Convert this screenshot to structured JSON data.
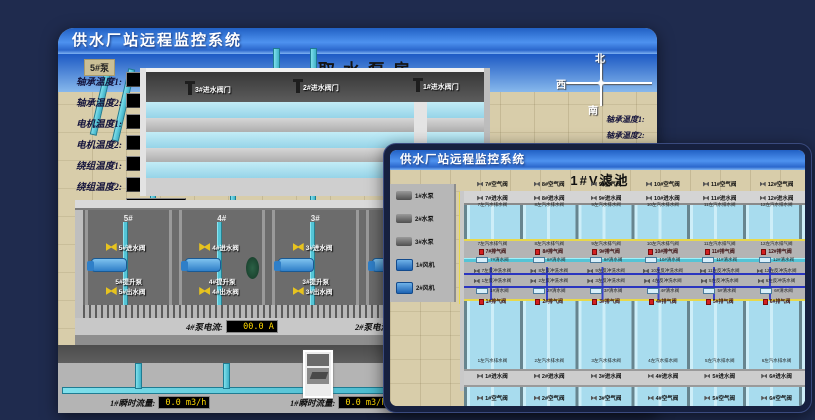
{
  "back_window": {
    "title": "供水厂站远程监控系统",
    "scene_title": "取水泵房",
    "pump_panel": {
      "tab": "5#泵",
      "rows": [
        {
          "label": "轴承温度1:",
          "value": "100.0℃"
        },
        {
          "label": "轴承温度2:",
          "value": "100.0℃"
        },
        {
          "label": "电机温度1:",
          "value": "18.1℃"
        },
        {
          "label": "电机温度2:",
          "value": "17.9℃"
        },
        {
          "label": "绕组温度1:",
          "value": "18.0℃"
        },
        {
          "label": "绕组温度2:",
          "value": "18.1℃"
        },
        {
          "label": "绕组温度3:",
          "value": "18.1℃"
        },
        {
          "label": "管道压力:",
          "value": "0.000MPa"
        },
        {
          "label": "多功能阀:",
          "value": "0%"
        }
      ]
    },
    "compass": {
      "north": "北",
      "west": "西",
      "south": "南"
    },
    "right_panel_labels": [
      {
        "label": "轴承温度1:"
      },
      {
        "label": "轴承温度2:"
      }
    ],
    "inlet_valves": [
      {
        "label": "3#进水阀门"
      },
      {
        "label": "2#进水阀门"
      },
      {
        "label": "1#进水阀门"
      }
    ],
    "pump_bays": [
      {
        "id": "5#",
        "inlet": "5#进水阀",
        "pump": "5#提升泵",
        "outlet": "5#出水阀"
      },
      {
        "id": "4#",
        "inlet": "4#进水阀",
        "pump": "4#提升泵",
        "outlet": "4#出水阀"
      },
      {
        "id": "3#",
        "inlet": "3#进水阀",
        "pump": "3#提升泵",
        "outlet": "3#出水阀"
      },
      {
        "id": "2#",
        "inlet": "2#进水阀",
        "pump": "2#提升泵",
        "outlet": "2#出水阀"
      }
    ],
    "current_displays": [
      {
        "label": "4#泵电流:",
        "value": "00.0 A"
      },
      {
        "label": "2#泵电流:",
        "value": ""
      }
    ],
    "flow_displays": [
      {
        "label": "1#瞬时流量:",
        "value": "0.0 m3/h"
      },
      {
        "label": "1#瞬时流量:",
        "value": "0.0 m3/h"
      }
    ]
  },
  "front_window": {
    "title": "供水厂站远程监控系统",
    "scene_title": "1#V滤池",
    "equipment": [
      {
        "label": "1#水泵"
      },
      {
        "label": "2#水泵"
      },
      {
        "label": "3#水泵"
      },
      {
        "label": "1#风机"
      },
      {
        "label": "2#风机"
      }
    ],
    "top_cells": [
      {
        "air": "7#空气阀",
        "inlet": "7#进水阀",
        "drain": "7左汽水排水阀",
        "vent": "7左汽水排气阀",
        "exhaust": "7#排气阀",
        "clean": "7#清水阀",
        "backwash": "7左反冲洗水阀"
      },
      {
        "air": "8#空气阀",
        "inlet": "8#进水阀",
        "drain": "8左汽水排水阀",
        "vent": "8左汽水排气阀",
        "exhaust": "8#排气阀",
        "clean": "8#清水阀",
        "backwash": "8左反冲洗水阀"
      },
      {
        "air": "9#空气阀",
        "inlet": "9#进水阀",
        "drain": "9左汽水排水阀",
        "vent": "9左汽水排气阀",
        "exhaust": "9#排气阀",
        "clean": "9#清水阀",
        "backwash": "9左反冲洗水阀"
      },
      {
        "air": "10#空气阀",
        "inlet": "10#进水阀",
        "drain": "10左汽水排水阀",
        "vent": "10左汽水排气阀",
        "exhaust": "10#排气阀",
        "clean": "10#清水阀",
        "backwash": "10左反冲洗水阀"
      },
      {
        "air": "11#空气阀",
        "inlet": "11#进水阀",
        "drain": "11左汽水排水阀",
        "vent": "11左汽水排气阀",
        "exhaust": "11#排气阀",
        "clean": "11#清水阀",
        "backwash": "11左反冲洗水阀"
      },
      {
        "air": "12#空气阀",
        "inlet": "12#进水阀",
        "drain": "12左汽水排水阀",
        "vent": "12左汽水排气阀",
        "exhaust": "12#排气阀",
        "clean": "12#清水阀",
        "backwash": "12左反冲洗水阀"
      }
    ],
    "bottom_cells": [
      {
        "backwash": "1左反冲洗水阀",
        "clean": "1#清水阀",
        "exhaust": "1#排气阀",
        "drain": "1左汽水排水阀",
        "inlet": "1#进水阀",
        "air": "1#空气阀"
      },
      {
        "backwash": "2左反冲洗水阀",
        "clean": "2#清水阀",
        "exhaust": "2#排气阀",
        "drain": "2左汽水排水阀",
        "inlet": "2#进水阀",
        "air": "2#空气阀"
      },
      {
        "backwash": "3左反冲洗水阀",
        "clean": "3#清水阀",
        "exhaust": "3#排气阀",
        "drain": "3左汽水排水阀",
        "inlet": "3#进水阀",
        "air": "3#空气阀"
      },
      {
        "backwash": "4左反冲洗水阀",
        "clean": "4#清水阀",
        "exhaust": "4#排气阀",
        "drain": "4左汽水排水阀",
        "inlet": "4#进水阀",
        "air": "4#空气阀"
      },
      {
        "backwash": "5左反冲洗水阀",
        "clean": "5#清水阀",
        "exhaust": "5#排气阀",
        "drain": "5左汽水排水阀",
        "inlet": "5#进水阀",
        "air": "5#空气阀"
      },
      {
        "backwash": "6左反冲洗水阀",
        "clean": "6#清水阀",
        "exhaust": "6#排气阀",
        "drain": "6左汽水排水阀",
        "inlet": "6#进水阀",
        "air": "6#空气阀"
      }
    ]
  },
  "colors": {
    "accent_blue": "#2f6fd4",
    "display_yellow": "#ffd900",
    "water": "#a8dcee",
    "floor": "#d8cdaa"
  }
}
